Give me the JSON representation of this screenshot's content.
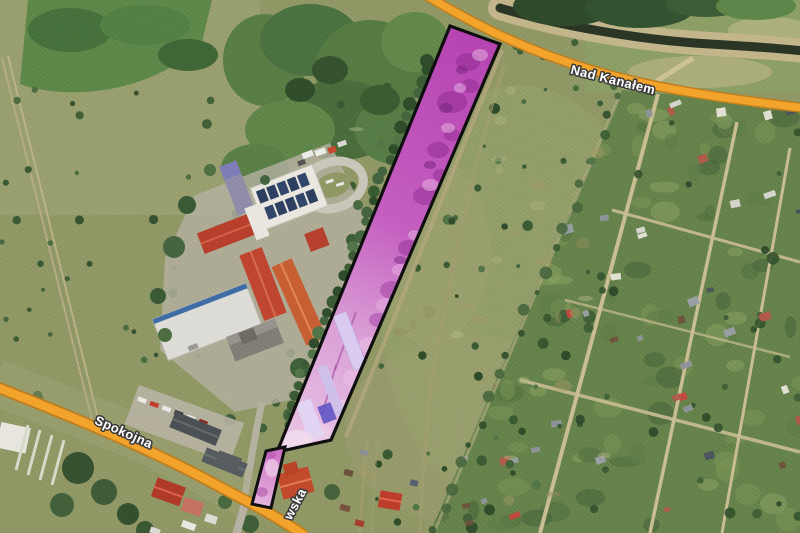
{
  "app": {
    "name": "satellite-map-view"
  },
  "labels": {
    "road_top": "Nad Kanałem",
    "road_left": "Spokojna",
    "road_bottom_partial": "wska"
  },
  "colors": {
    "road_fill": "#f3a32b",
    "road_casing": "#bd7e20",
    "parcel_border": "#0e0e0e",
    "parcel_fill": "#c45ec0",
    "water": "#2b3525",
    "label_fill": "#ffffff",
    "label_outline": "#3a3a3a"
  },
  "features": {
    "highlighted_parcel_count": 2
  }
}
